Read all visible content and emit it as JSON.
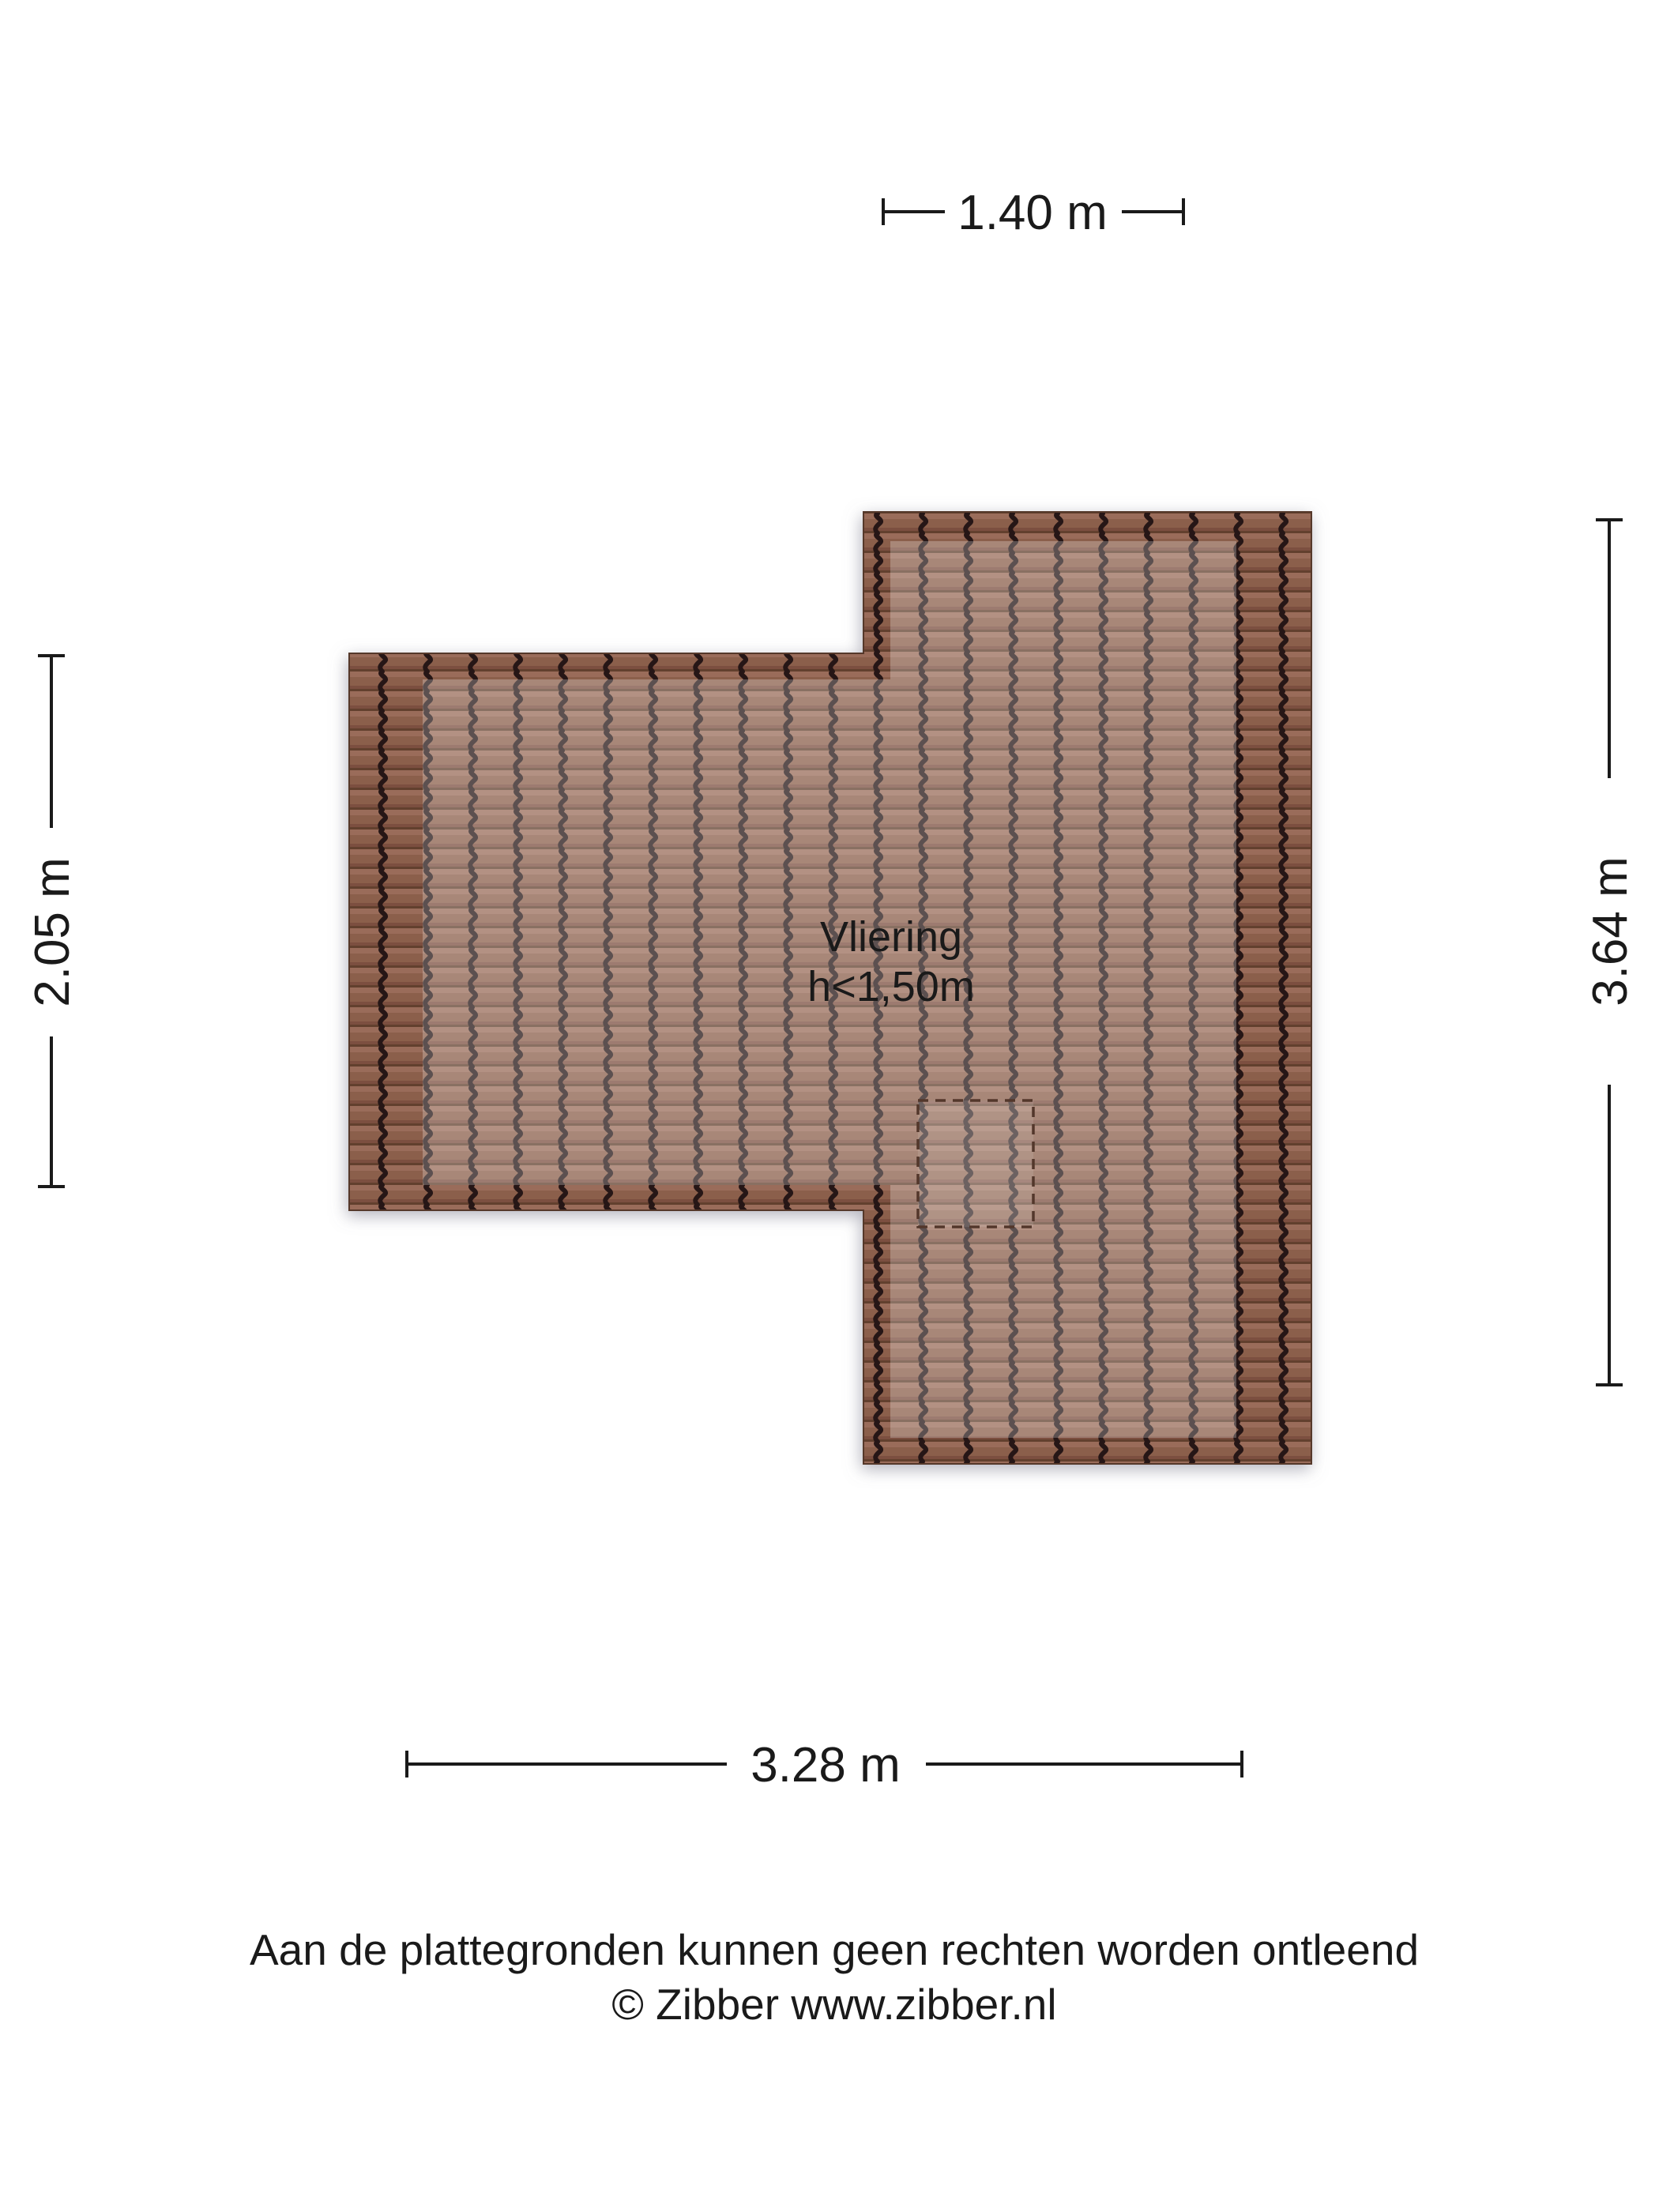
{
  "page": {
    "disclaimer_line1": "Aan de plattegronden kunnen geen rechten worden ontleend",
    "disclaimer_line2": "© Zibber www.zibber.nl"
  },
  "floorplan": {
    "room": {
      "name": "Vliering",
      "height_note": "h<1,50m"
    },
    "dimensions": {
      "top": {
        "label": "1.40 m",
        "meters": 1.4
      },
      "left": {
        "label": "2.05 m",
        "meters": 2.05
      },
      "right": {
        "label": "3.64 m",
        "meters": 3.64
      },
      "bottom": {
        "label": "3.28 m",
        "meters": 3.28
      }
    },
    "colors": {
      "tile_row_light": "#9a6c5a",
      "tile_row_mid": "#8b5e4c",
      "tile_row_dark": "#7c5040",
      "tile_row_edge": "#62402f",
      "tile_groove": "#261712",
      "roof_outline": "#54382c",
      "interior_overlay": "rgba(255,255,255,0.25)",
      "dashed_outline": "#53372b",
      "dimension_ink": "#1a1a1a",
      "shadow": "#777788"
    }
  }
}
